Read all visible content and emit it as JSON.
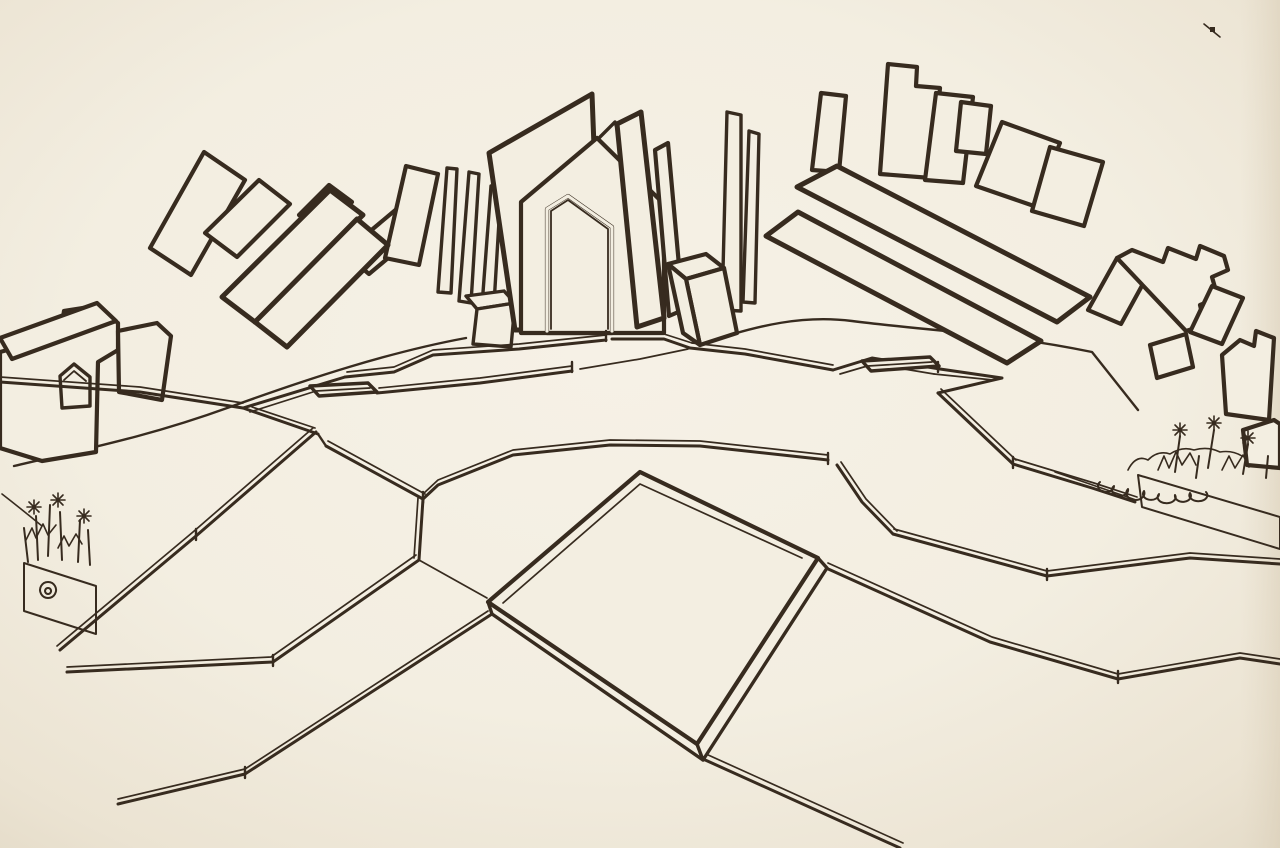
{
  "artwork": {
    "kind": "freehand-ink-perspective-sketch",
    "colors": {
      "paper": "#f4efe3",
      "paper_edge": "#e6ddcb",
      "ink": "#372b1f",
      "hatch": "#4a3a2a",
      "gate_interior": "#d8cbb2"
    },
    "scene_elements": [
      "left-city-skyline",
      "left-crosshatch-buildings",
      "central-gate-structure",
      "gate-opening",
      "right-city-skyline",
      "right-crosshatch-buildings",
      "plaza-terraces",
      "left-arrow-platform",
      "right-arrow-platform",
      "central-diamond-platform",
      "left-shrub-planter",
      "right-shrub-planter",
      "paper-speck"
    ]
  }
}
